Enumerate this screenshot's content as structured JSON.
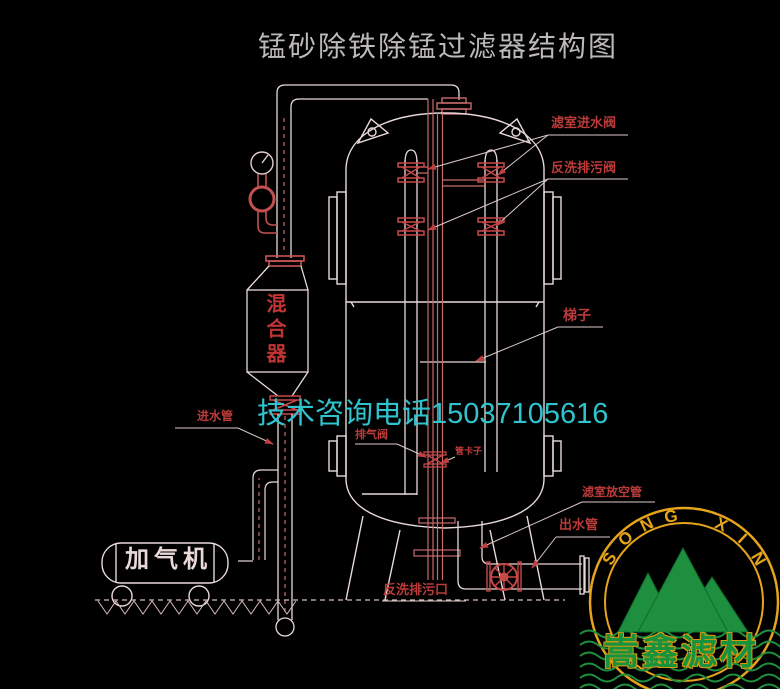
{
  "title": "锰砂除铁除锰过滤器结构图",
  "watermark": {
    "phone_text": "技术咨询电话15037105616"
  },
  "labels": {
    "chamber_inlet_valve": "滤室进水阀",
    "backwash_drain_valve": "反洗排污阀",
    "ladder": "梯子",
    "chamber_vent_pipe": "滤室放空管",
    "outlet_pipe": "出水管",
    "inlet_pipe": "进水管",
    "exhaust_valve": "排气阀",
    "pipe_clamp": "管卡子",
    "backwash_drain_outlet": "反洗排污口",
    "mixer": "混合器",
    "aerator": "加气机"
  },
  "logo": {
    "arc_text": "SONG XIN",
    "brand": "嵩鑫滤材"
  },
  "colors": {
    "background": "#000000",
    "line_white": "#e9d9d9",
    "pipe_red": "#c96b6b",
    "valve_red": "#c44444",
    "label_red": "#bb3b3b",
    "watermark_cyan": "#2fc3cd",
    "title_gray": "#bdb9b9",
    "logo_yellow": "#e6a31c",
    "logo_green": "#1e8f3e"
  }
}
